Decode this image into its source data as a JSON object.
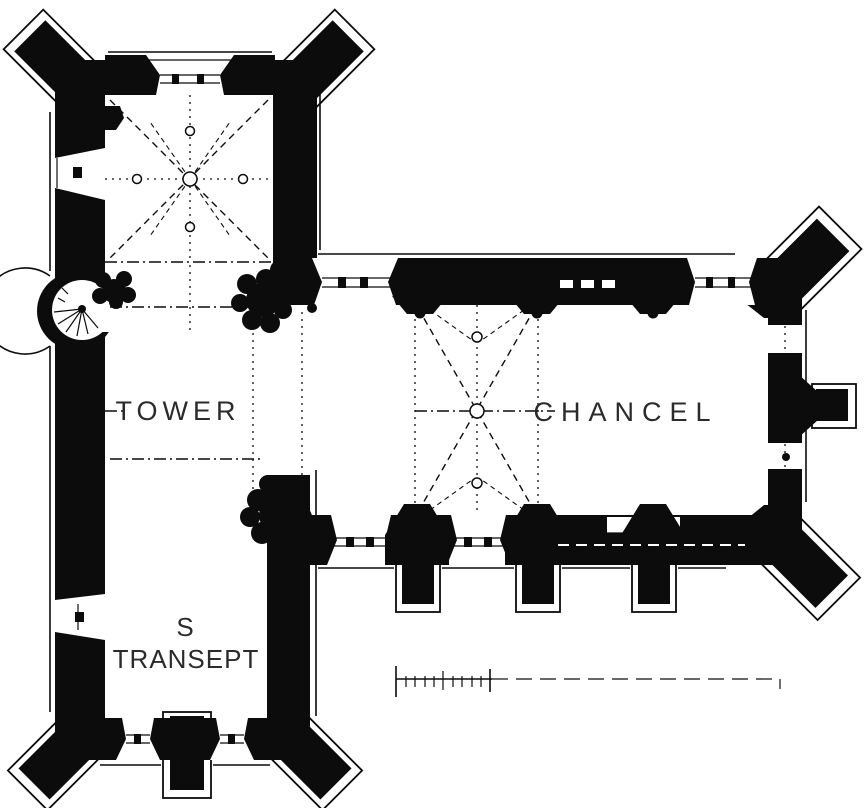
{
  "drawing": {
    "labels": {
      "tower": "TOWER",
      "s_transept_line1": "S",
      "s_transept_line2": "TRANSEPT",
      "chancel": "CHANCEL"
    },
    "colors": {
      "ink": "#0c0c0c",
      "paper": "#ffffff",
      "label_ink": "#2b2b2b"
    }
  }
}
